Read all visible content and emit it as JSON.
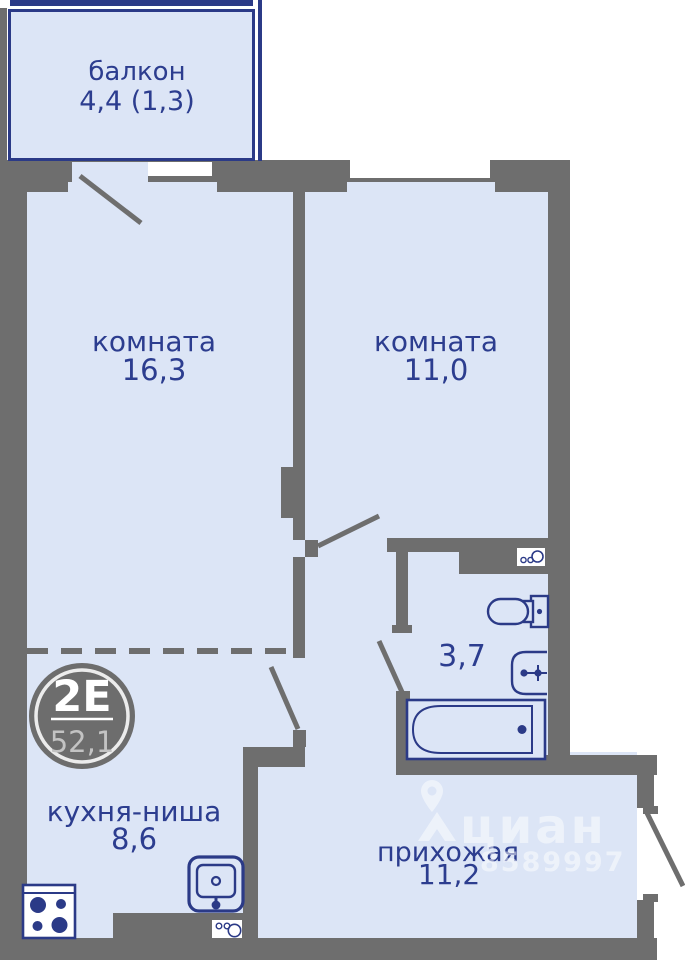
{
  "floor_plan": {
    "badge": {
      "plan_type": "2Е",
      "total_area": "52,1"
    },
    "rooms": {
      "balcony": {
        "name": "балкон",
        "area": "4,4 (1,3)"
      },
      "room1": {
        "name": "комната",
        "area": "16,3"
      },
      "room2": {
        "name": "комната",
        "area": "11,0"
      },
      "bathroom": {
        "area": "3,7"
      },
      "kitchen": {
        "name": "кухня-ниша",
        "area": "8,6"
      },
      "hallway": {
        "name": "прихожая",
        "area": "11,2"
      }
    },
    "watermark": {
      "brand": "циан",
      "id_number": "8589997"
    },
    "colors": {
      "wall_gray": "#6e6e6e",
      "room_fill": "#dce5f6",
      "fixture_navy": "#2b3a87",
      "label_navy": "#2c3d8f",
      "badge_gray": "#6d6d6d"
    }
  }
}
